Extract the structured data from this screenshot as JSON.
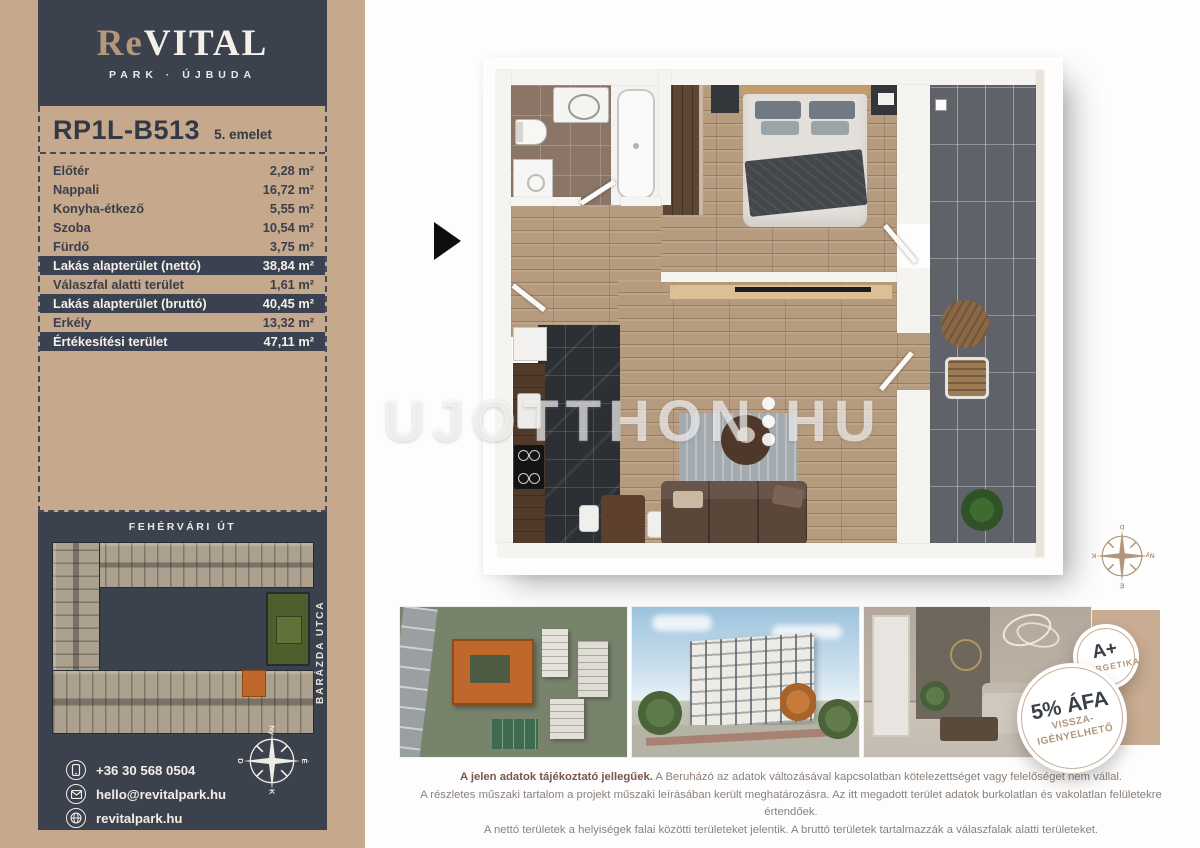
{
  "brand": {
    "name_accent": "Re",
    "name_rest": "VITAL",
    "subtitle": "PARK · ÚJBUDA"
  },
  "unit": {
    "code": "RP1L-B513",
    "floor": "5. emelet"
  },
  "areas": {
    "rows": [
      {
        "label": "Előtér",
        "value": "2,28 m²",
        "highlight": false
      },
      {
        "label": "Nappali",
        "value": "16,72 m²",
        "highlight": false
      },
      {
        "label": "Konyha-étkező",
        "value": "5,55 m²",
        "highlight": false
      },
      {
        "label": "Szoba",
        "value": "10,54 m²",
        "highlight": false
      },
      {
        "label": "Fürdő",
        "value": "3,75 m²",
        "highlight": false
      },
      {
        "label": "Lakás alapterület (nettó)",
        "value": "38,84 m²",
        "highlight": true
      },
      {
        "label": "Válaszfal alatti terület",
        "value": "1,61 m²",
        "highlight": false
      },
      {
        "label": "Lakás alapterület (bruttó)",
        "value": "40,45 m²",
        "highlight": true
      },
      {
        "label": "Erkély",
        "value": "13,32 m²",
        "highlight": false
      },
      {
        "label": "Értékesítési terület",
        "value": "47,11 m²",
        "highlight": true
      }
    ]
  },
  "site_plan": {
    "street_top": "FEHÉRVÁRI ÚT",
    "street_right": "BARÁZDA UTCA"
  },
  "contact": {
    "phone": "+36 30 568 0504",
    "email": "hello@revitalpark.hu",
    "website": "revitalpark.hu"
  },
  "watermark": {
    "left": "UJOTTHON",
    "right": "HU"
  },
  "badges": {
    "energy": {
      "line1": "A+",
      "line2": "ENERGETIKA"
    },
    "vat": {
      "line1": "5% ÁFA",
      "line2": "VISSZA-",
      "line3": "IGÉNYELHETŐ"
    }
  },
  "compass": {
    "north": "É",
    "east": "K",
    "south": "D",
    "west": "Ny"
  },
  "disclaimer": {
    "lead": "A jelen adatok tájékoztató jellegűek.",
    "line1": "A Beruházó az adatok változásával kapcsolatban kötelezettséget vagy felelőséget nem vállal.",
    "line2": "A részletes műszaki tartalom a projekt műszaki leírásában került meghatározásra. Az itt megadott terület adatok burkolatlan és vakolatlan felületekre értendőek.",
    "line3": "A nettó területek a helyiségek falai közötti területeket jelentik. A bruttó területek tartalmazzák a válaszfalak alatti területeket."
  },
  "colors": {
    "tan": "#c6a88c",
    "dark": "#3c414e",
    "orange": "#c0682c",
    "green": "#4e5f2e",
    "badge_ring": "#c8ae92"
  }
}
